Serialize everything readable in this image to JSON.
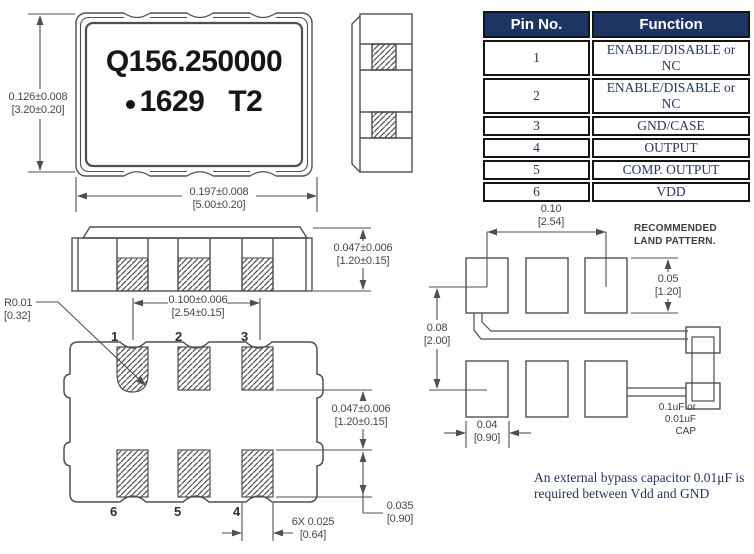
{
  "marking": {
    "line1": "Q156.250000",
    "line2_num": "1629",
    "line2_code": "T2"
  },
  "table": {
    "headers": [
      "Pin No.",
      "Function"
    ],
    "rows": [
      [
        "1",
        "ENABLE/DISABLE or NC"
      ],
      [
        "2",
        "ENABLE/DISABLE or NC"
      ],
      [
        "3",
        "GND/CASE"
      ],
      [
        "4",
        "OUTPUT"
      ],
      [
        "5",
        "COMP. OUTPUT"
      ],
      [
        "6",
        "VDD"
      ]
    ]
  },
  "dims": {
    "top_height": {
      "in": "0.126±0.008",
      "mm": "[3.20±0.20]"
    },
    "top_width": {
      "in": "0.197±0.008",
      "mm": "[5.00±0.20]"
    },
    "side_height": {
      "in": "0.047±0.006",
      "mm": "[1.20±0.15]"
    },
    "pad_pitch": {
      "in": "0.100±0.006",
      "mm": "[2.54±0.15]"
    },
    "corner_radius": {
      "in": "R0.01",
      "mm": "[0.32]"
    },
    "row_gap": {
      "in": "0.047±0.006",
      "mm": "[1.20±0.15]"
    },
    "pad_height": {
      "in": "0.035",
      "mm": "[0.90]"
    },
    "pad_width_6x": {
      "in": "6X  0.025",
      "mm": "[0.64]"
    },
    "land_pitch": {
      "in": "0.10",
      "mm": "[2.54]"
    },
    "land_pad_height": {
      "in": "0.05",
      "mm": "[1.20]"
    },
    "land_row_gap": {
      "in": "0.08",
      "mm": "[2.00]"
    },
    "land_pad_width": {
      "in": "0.04",
      "mm": "[0.90]"
    }
  },
  "bottom_view": {
    "pad_labels_top": [
      "1",
      "2",
      "3"
    ],
    "pad_labels_bottom": [
      "6",
      "5",
      "4"
    ]
  },
  "land_pattern": {
    "title_line1": "RECOMMENDED",
    "title_line2": "LAND PATTERN.",
    "cap_line1": "0.1uF or",
    "cap_line2": "0.01uF",
    "cap_line3": "CAP"
  },
  "note": {
    "line1": "An external bypass capacitor 0.01μF is",
    "line2": "required between Vdd and GND"
  },
  "colors": {
    "table_header_bg": "#1c3563",
    "table_text": "#26355e",
    "drawing_line": "#4f4f4f"
  }
}
